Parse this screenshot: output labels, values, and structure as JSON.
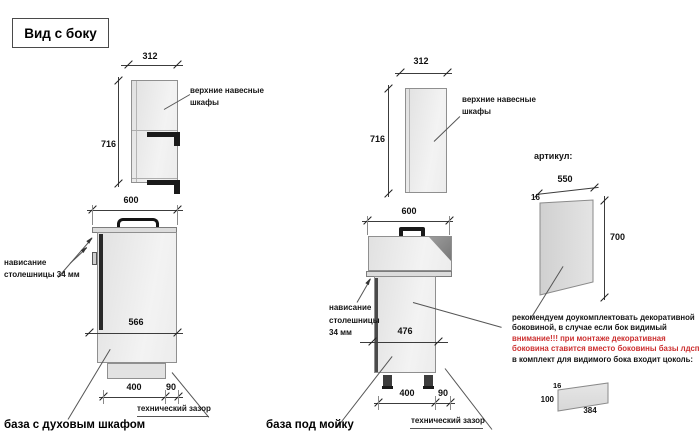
{
  "title": "Вид с боку",
  "colors": {
    "note_red": "#cc2f2f",
    "drawing_line": "#3c3c3c",
    "cabinet_fill": "#ececec"
  },
  "left": {
    "upper": {
      "width_dim": "312",
      "height_dim": "716",
      "label1": "верхние навесные",
      "label2": "шкафы"
    },
    "base": {
      "width_dim": "600",
      "depth_dim": "566",
      "overhang1": "нависание",
      "overhang2": "столешницы 34 мм",
      "bottom_dim1": "400",
      "bottom_dim2": "90",
      "gap_label": "технический зазор",
      "caption": "база с духовым шкафом"
    }
  },
  "middle": {
    "upper": {
      "width_dim": "312",
      "height_dim": "716",
      "label1": "верхние навесные",
      "label2": "шкафы"
    },
    "base": {
      "width_dim": "600",
      "depth_dim": "476",
      "overhang1": "нависание",
      "overhang2": "столешницы",
      "overhang3": "34 мм",
      "bottom_dim1": "400",
      "bottom_dim2": "90",
      "gap_label": "технический зазор",
      "caption": "база под мойку"
    }
  },
  "panel": {
    "heading": "артикул:",
    "width_dim": "550",
    "thickness_dim": "16",
    "height_dim": "700"
  },
  "note": {
    "line1": "рекомендуем доукомплектовать декоративной",
    "line2": "боковиной, в случае если бок видимый",
    "line3": "внимание!!! при монтаже декоративная",
    "line4": "боковина ставится вместо боковины базы лдсп",
    "line5": "в комплект для видимого бока входит цоколь:"
  },
  "plinth": {
    "thickness_dim": "16",
    "height_dim": "100",
    "length_dim": "384"
  }
}
